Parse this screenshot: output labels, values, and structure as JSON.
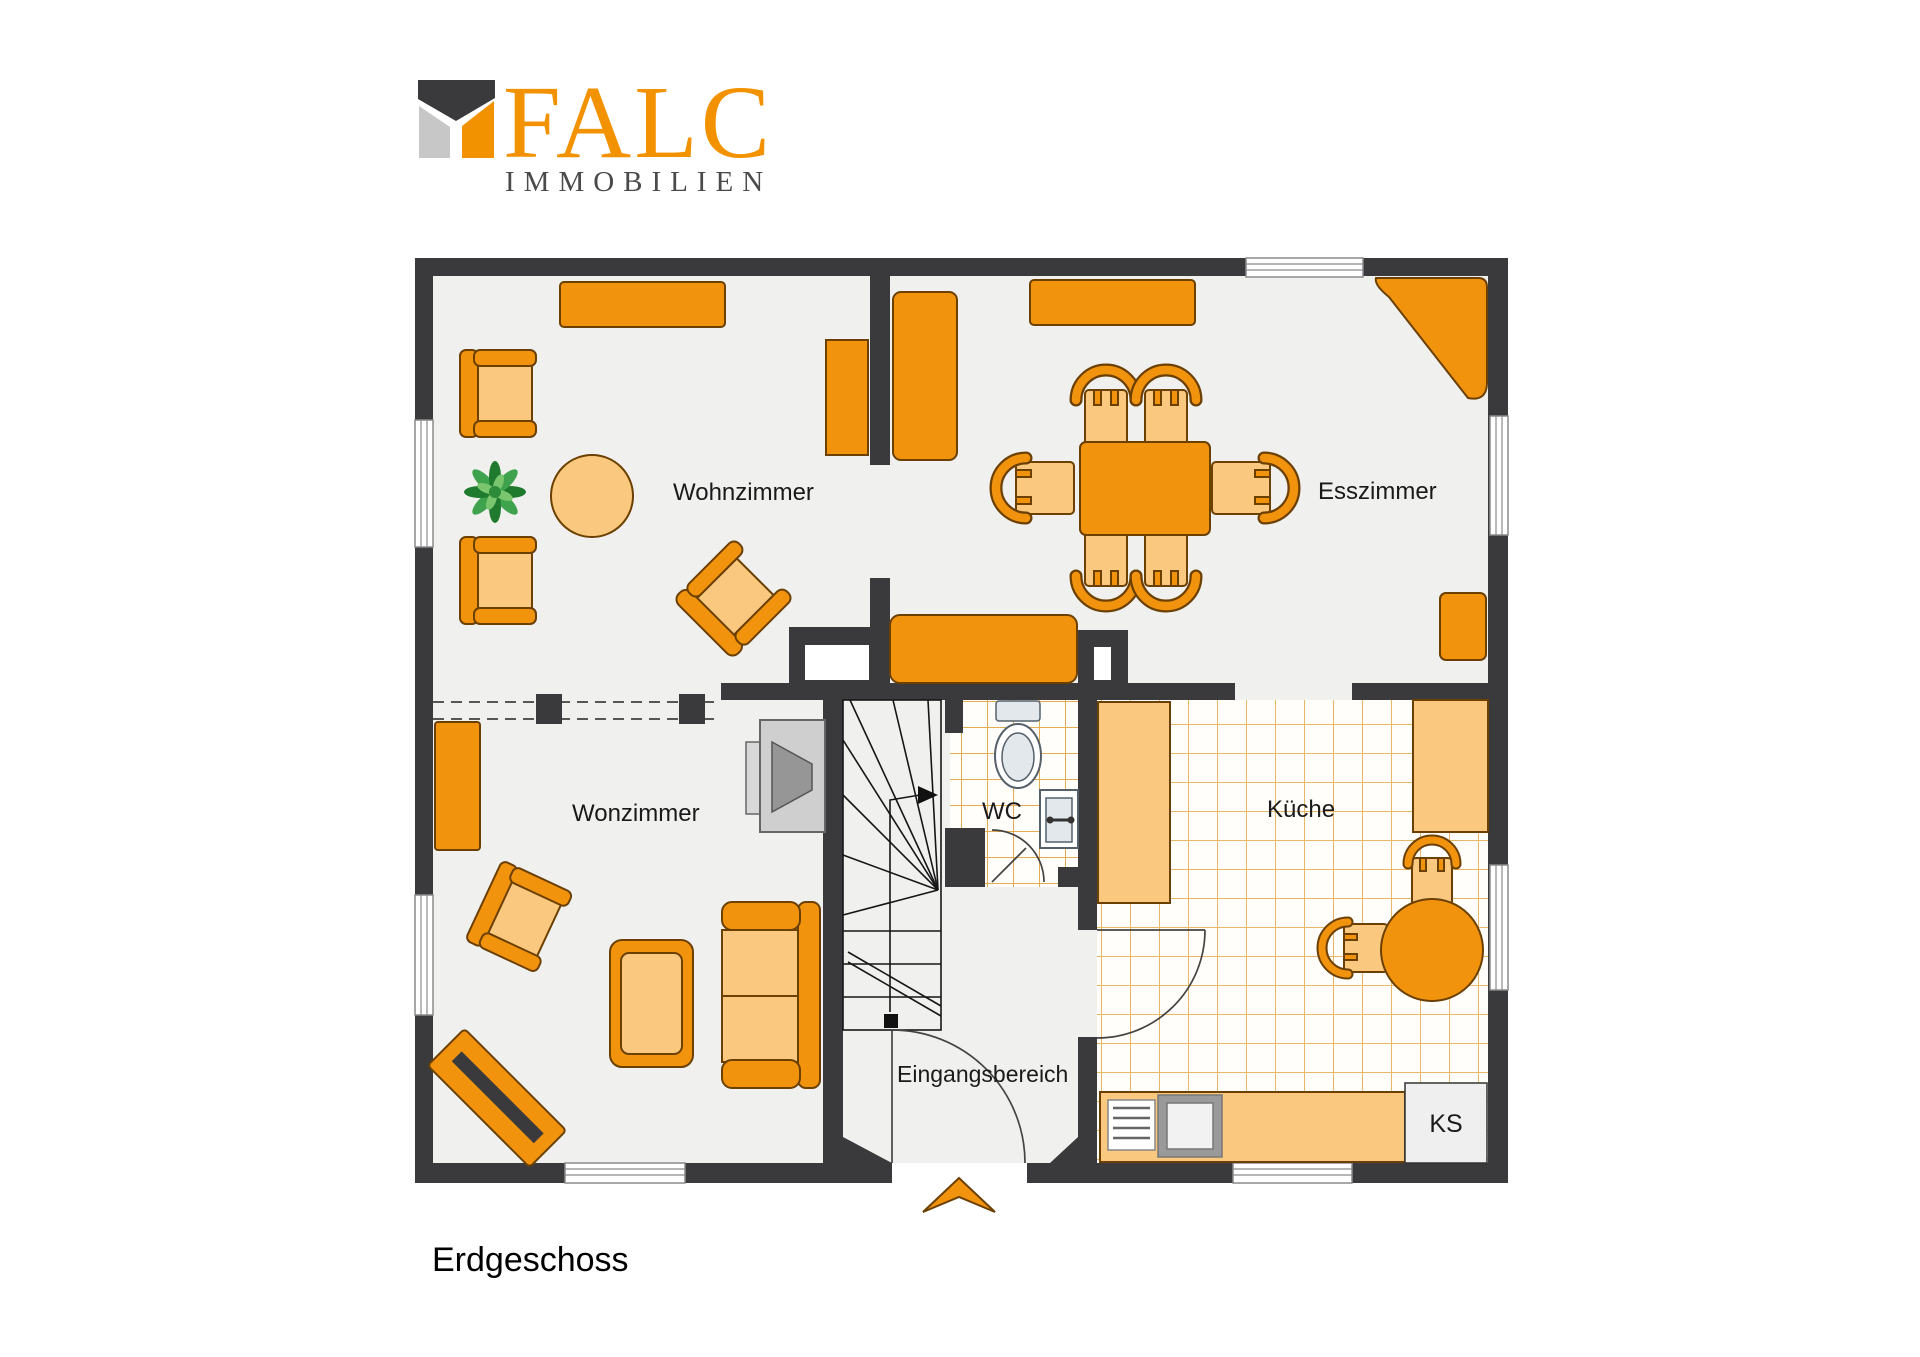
{
  "brand": {
    "name": "FALC",
    "subtitle": "IMMOBILIEN"
  },
  "floor_label": "Erdgeschoss",
  "rooms": {
    "wohnzimmer": "Wohnzimmer",
    "esszimmer": "Esszimmer",
    "wonzimmer": "Wonzimmer",
    "wc": "WC",
    "kueche": "Küche",
    "eingangsbereich": "Eingangsbereich"
  },
  "appliances": {
    "fridge_label": "KS"
  },
  "colors": {
    "wall": "#3A3A3C",
    "floor": "#F0F0EF",
    "furniture": "#F2930D",
    "furniture_light": "#FAC87E",
    "furniture_outline": "#6B4000",
    "tile_line": "#E8B763",
    "brand_orange": "#F39200",
    "brand_gray": "#C7C7C7",
    "brand_dark": "#3A3A3C",
    "brand_text": "#4A4A4C",
    "label_text": "#1A1A1A",
    "plant_green": "#2E8B3A"
  }
}
